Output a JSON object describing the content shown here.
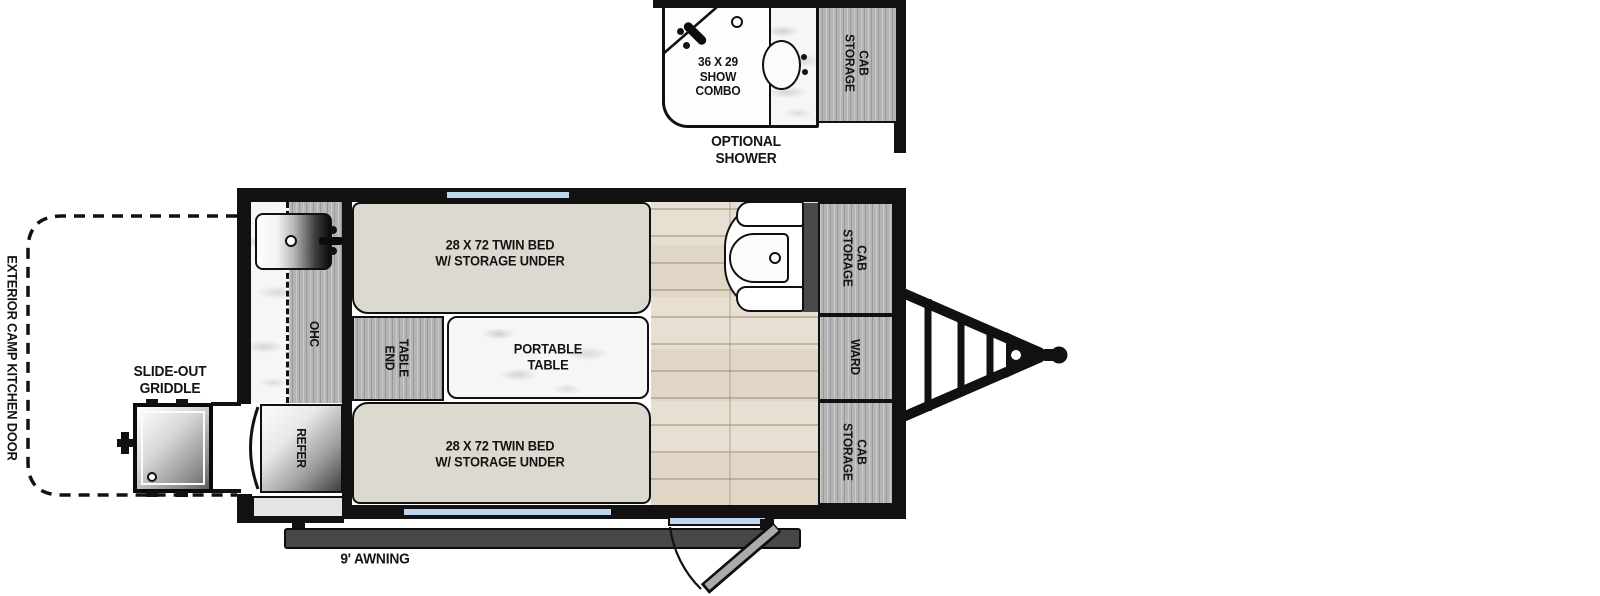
{
  "colors": {
    "wall": "#111111",
    "window_blue": "#bdd7ee",
    "cabinet_wood_gray": "#b5b5b5",
    "bed_fill": "#dcd9d1",
    "floor_tan": "#e6dfd2",
    "awning_gray": "#474747",
    "accent_dark_wall": "#4a4a4a"
  },
  "inset": {
    "shower_lines": [
      "36 X 29",
      "SHOW",
      "COMBO"
    ],
    "storage_cab": [
      "STORAGE",
      "CAB"
    ],
    "caption": [
      "OPTIONAL",
      "SHOWER"
    ]
  },
  "main": {
    "bed_top": [
      "28 X 72 TWIN BED",
      "W/ STORAGE UNDER"
    ],
    "bed_bottom": [
      "28 X 72 TWIN BED",
      "W/ STORAGE UNDER"
    ],
    "portable_table": [
      "PORTABLE",
      "TABLE"
    ],
    "end_table": [
      "END",
      "TABLE"
    ],
    "ohc": "OHC",
    "refer": "REFER",
    "ward": "WARD",
    "storage_cab_top": [
      "STORAGE",
      "CAB"
    ],
    "storage_cab_bottom": [
      "STORAGE",
      "CAB"
    ]
  },
  "exterior": {
    "camp_kitchen_door": "EXTERIOR CAMP KITCHEN DOOR",
    "slide_out_griddle": [
      "SLIDE-OUT",
      "GRIDDLE"
    ],
    "awning": "9' AWNING"
  }
}
